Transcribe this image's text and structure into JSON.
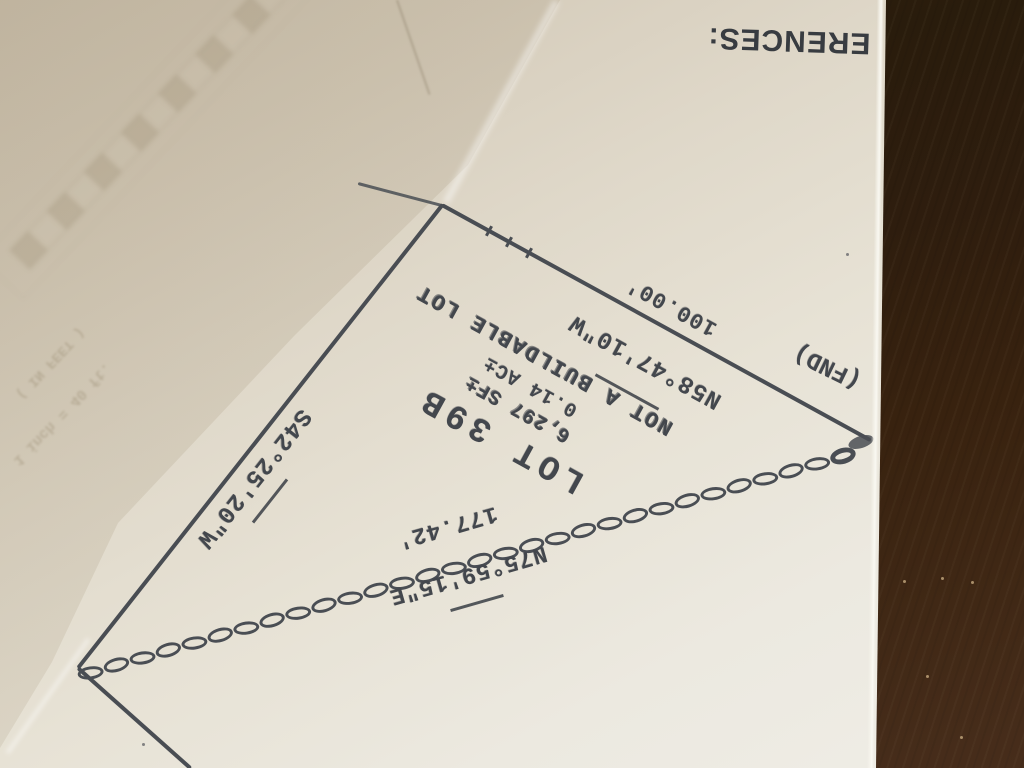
{
  "document": {
    "heading_partial": "ERENCES:",
    "stamp": {
      "lot_label": "LOT 39B",
      "area_sqft": "6,297 SF±",
      "area_acres": "0.14 AC±",
      "note": "NOT A BUILDABLE LOT"
    },
    "boundaries": {
      "northeast_edge": {
        "bearing": "N58°47'10\"W",
        "distance": "100.00'"
      },
      "west_edge": {
        "bearing": "S42°25'20\"W"
      },
      "south_edge": {
        "bearing": "N75°59'15\"E",
        "distance": "177.42'"
      },
      "corner_monument": "(FND)"
    },
    "showthrough": {
      "scale_units": "( IN FEET )",
      "scale_text": "1 inch = 40 ft."
    }
  },
  "colors": {
    "paper": "#e7e2d5",
    "paper_shadow": "#cdc3b1",
    "ink": "#43474d",
    "table_wood_dark": "#2a1c0c",
    "table_wood_light": "#472d1b"
  }
}
